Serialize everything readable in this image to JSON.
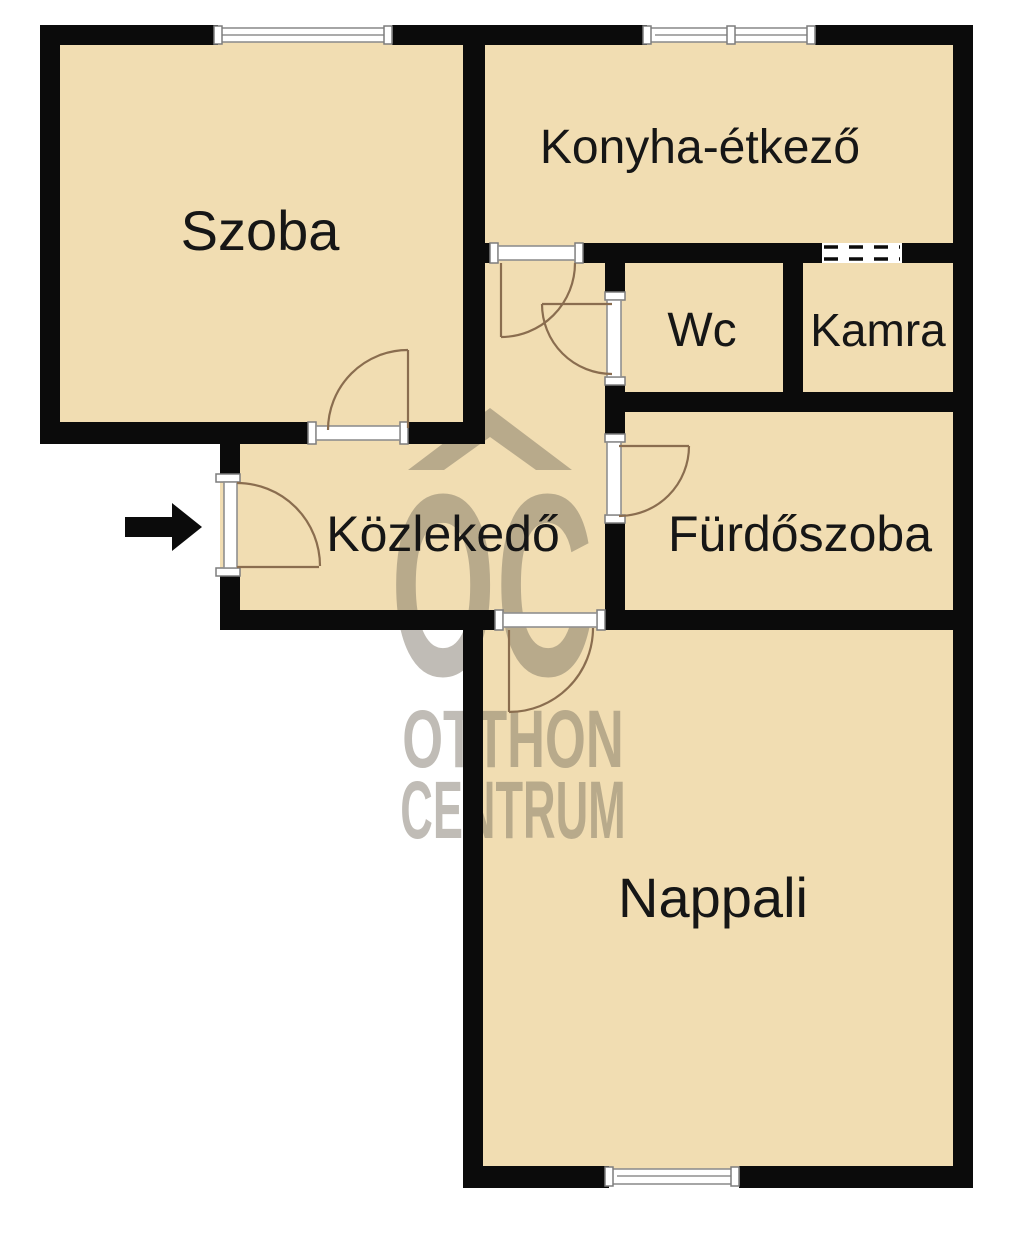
{
  "rooms": {
    "szoba": "Szoba",
    "konyha_etkezo": "Konyha-étkező",
    "wc": "Wc",
    "kamra": "Kamra",
    "kozlekedo": "Közlekedő",
    "furdoszoba": "Fürdőszoba",
    "nappali": "Nappali"
  },
  "watermark": {
    "logo": "OC",
    "line1": "OTTHON",
    "line2": "CENTRUM"
  },
  "icons": {
    "entrance_arrow": "right-arrow",
    "watermark_roof": "house-roof"
  },
  "colors": {
    "floor": "#F1DDB2",
    "wall": "#0B0B0B",
    "door_arc": "#8A6D4F",
    "window_frame": "#8F8F8F",
    "watermark": "#756D5E"
  }
}
